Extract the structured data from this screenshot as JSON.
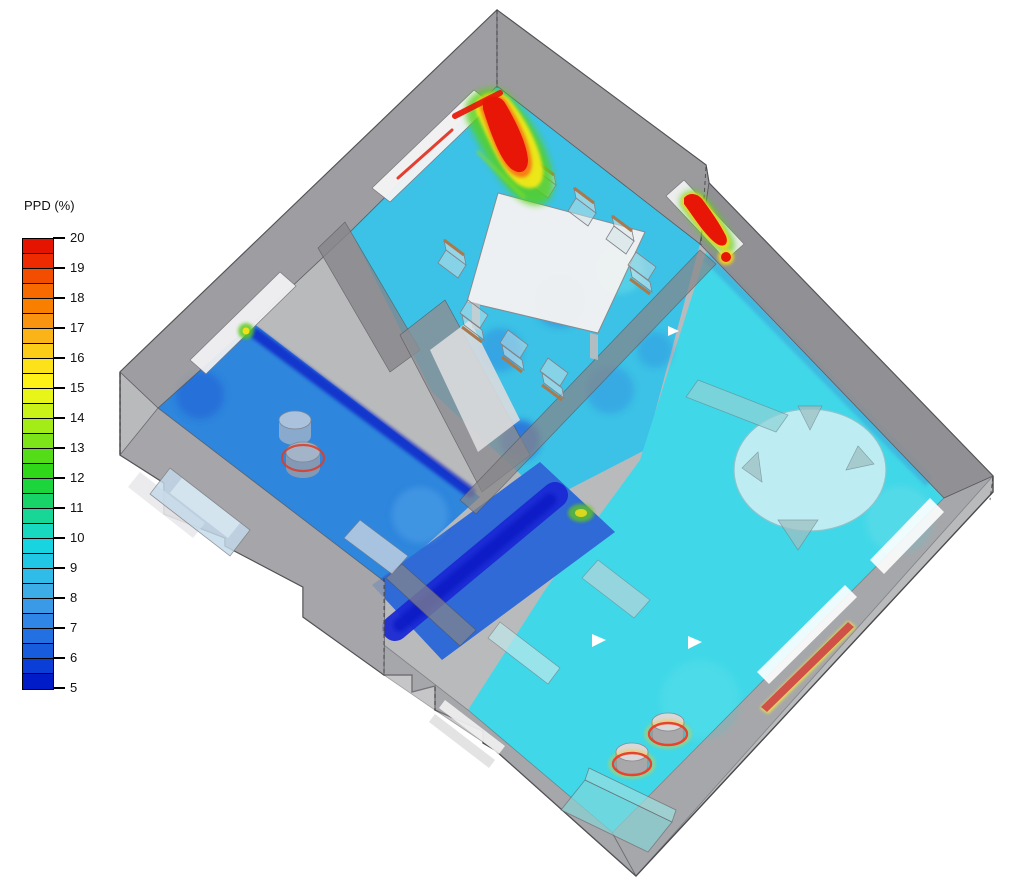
{
  "legend": {
    "title": "PPD (%)",
    "variable": "PPD",
    "unit": "%",
    "min": 5,
    "max": 20,
    "tick_step": 1,
    "band_step": 0.5,
    "ticks": [
      20,
      19,
      18,
      17,
      16,
      15,
      14,
      13,
      12,
      11,
      10,
      9,
      8,
      7,
      6,
      5
    ],
    "band_colors_top_to_bottom": [
      "#e51400",
      "#ee2a00",
      "#f34e00",
      "#f66a00",
      "#f87f00",
      "#f99410",
      "#fab418",
      "#fbcc18",
      "#fce218",
      "#fdf118",
      "#e8f518",
      "#c8f218",
      "#a4ec18",
      "#7ce418",
      "#54dc18",
      "#30d618",
      "#1cd43c",
      "#18d468",
      "#18d695",
      "#18d8c0",
      "#18d4e0",
      "#20c8e6",
      "#2fbce8",
      "#3dade8",
      "#3a9ae8",
      "#2f86e6",
      "#2270e2",
      "#165cdc",
      "#0b3ed6",
      "#001bc8"
    ]
  },
  "scene": {
    "view": "isometric 3D cutaway of apartment with floor PPD contour plot",
    "colors": {
      "background": "#ffffff",
      "wall_gray": "#9a9a9e",
      "floor_living_cyan": "#40d8e8",
      "floor_dining_cyan": "#3cc2e6",
      "floor_bedroom_blue": "#2e86dd",
      "floor_hall_navy": "#1522d2",
      "hotspot_red": "#e81606",
      "radiator_red": "#cf5148",
      "rug_light": "#c9eef4",
      "window_white": "#f4f4f5"
    },
    "rooms": [
      {
        "name": "dining-room",
        "position": "top-center",
        "approx_ppd": "8-11"
      },
      {
        "name": "living-room",
        "position": "right",
        "approx_ppd": "9-10"
      },
      {
        "name": "bedroom",
        "position": "left-wing",
        "approx_ppd": "6-8"
      },
      {
        "name": "hallway-corridor",
        "position": "center",
        "approx_ppd": "5-6"
      }
    ],
    "furniture": [
      "dining-table",
      "dining-chairs-x8",
      "round-rug",
      "rug-chairs-x4",
      "living-bench",
      "living-sofa",
      "stool-x2",
      "bedroom-sofa",
      "bedroom-cylinders-x2",
      "side-table",
      "hall-cabinet",
      "entry-steps"
    ],
    "hotspots": [
      {
        "name": "north-corner-window-plume",
        "approx_ppd": "20+"
      },
      {
        "name": "east-window-plume",
        "approx_ppd": "20+"
      },
      {
        "name": "se-wall-radiator-strip",
        "approx_ppd": "18-20"
      },
      {
        "name": "stool-heat-rings",
        "approx_ppd": "15-20"
      },
      {
        "name": "bedroom-cylinder-ring",
        "approx_ppd": "15-18"
      },
      {
        "name": "corridor-green-spot",
        "approx_ppd": "12-14"
      },
      {
        "name": "bedroom-corner-green-spot",
        "approx_ppd": "12-14"
      }
    ]
  },
  "chart_data": {
    "type": "heatmap",
    "title": "PPD (%)",
    "variable": "Predicted Percentage of Dissatisfied",
    "scale": {
      "min": 5,
      "max": 20,
      "contour_step": 0.5,
      "tick_labels": [
        20,
        19,
        18,
        17,
        16,
        15,
        14,
        13,
        12,
        11,
        10,
        9,
        8,
        7,
        6,
        5
      ]
    },
    "legend_position": "left",
    "surfaces": [
      {
        "region": "living-room floor",
        "value_range": [
          9,
          10
        ]
      },
      {
        "region": "dining-room floor",
        "value_range": [
          8,
          11
        ]
      },
      {
        "region": "bedroom floor",
        "value_range": [
          6,
          8
        ]
      },
      {
        "region": "hallway floor",
        "value_range": [
          5,
          6
        ]
      },
      {
        "region": "north corner window plume",
        "value_range": [
          14,
          20
        ]
      },
      {
        "region": "east window plume",
        "value_range": [
          14,
          20
        ]
      },
      {
        "region": "SE wall radiator",
        "value_range": [
          18,
          20
        ]
      },
      {
        "region": "stool perimeters",
        "value_range": [
          15,
          20
        ]
      }
    ]
  }
}
